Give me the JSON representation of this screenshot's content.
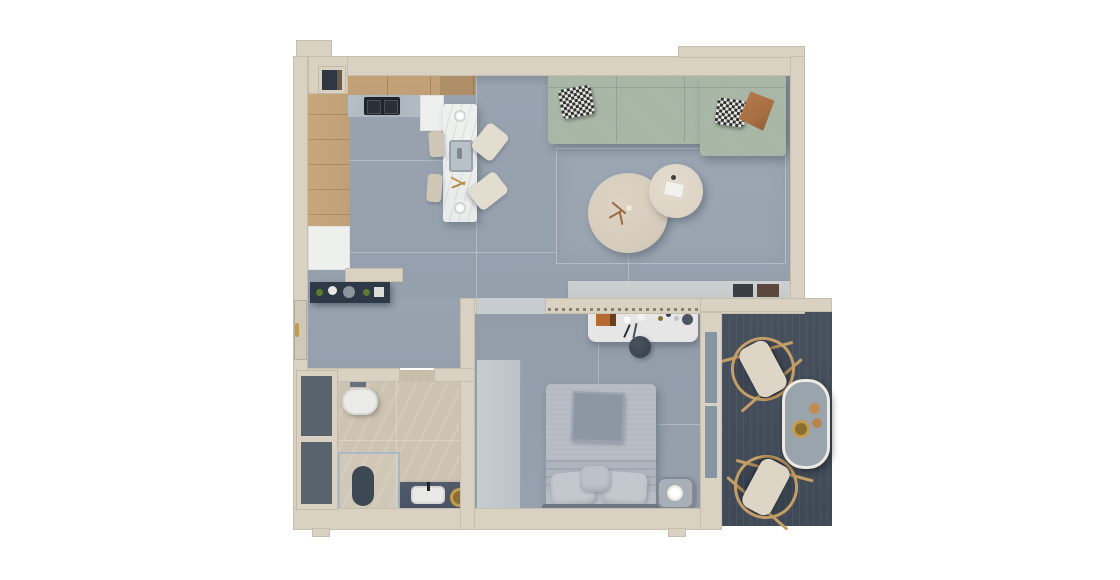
{
  "app": {
    "type": "apartment-floor-plan-3d-top-view",
    "canvas": {
      "width": 1120,
      "height": 580
    },
    "visible_text": []
  },
  "palette": {
    "background": "#ffffff",
    "wall": "#d9d2c3",
    "doorLeaf": "#d0c8b8",
    "floorLiving": "#99a3b0",
    "floorBedroom": "#939daa",
    "floorThreshold": "#c7ccd1",
    "wood": "#c2a077",
    "woodDark": "#a8865e",
    "counterMarble": "#aab3bd",
    "cooktop": "#20242a",
    "cabinetWhite": "#eef0ee",
    "islandMarble": "#e9ebea",
    "chairCream": "#e3ddd0",
    "chairBeige": "#cfc6b6",
    "sofa": "#a7b5a5",
    "pillowCheckDark": "#2e3133",
    "pillowCheckLight": "#e7e4de",
    "pillowRust": "#a76f42",
    "coffeeTableLarge": "#d5cbbb",
    "coffeeTableSmall": "#dcd3c5",
    "tvConsole": "#c6c9c9",
    "artDark": "#3a3e44",
    "artBrown": "#5c473c",
    "sideboardNavy": "#2d3947",
    "plantGreen": "#5d7a2e",
    "gold": "#c59b4e",
    "bathTile": "#cdc3b2",
    "toiletWhite": "#ebebe9",
    "showerTray": "#3e4854",
    "vanityDark": "#4a5363",
    "sinkWhite": "#e9e9e7",
    "shaftDark": "#59636e",
    "wardrobe": "#c5ccd2",
    "deskWhite": "#e5e6e5",
    "accentOrange": "#b46a30",
    "stoolDark": "#3a434e",
    "bedDuvet": "#b5bbc3",
    "bedFold": "#8d97a4",
    "bedSheet": "#aeb5bf",
    "bedPillow": "#c3c8cf",
    "headboard": "#6e7784",
    "nightstand": "#a9afb8",
    "deck": "#47515d",
    "chairWood": "#c49e66",
    "chairCushion": "#ddd6c7",
    "balconyTable": "#9aa4ad",
    "balconyTableRim": "#eceae2",
    "glass": "#8695a2"
  },
  "rooms": [
    {
      "id": "kitchen",
      "furniture": [
        "wood-floor-strip",
        "upper-cabinet-row",
        "cooktop",
        "counter",
        "white-cabinets",
        "marble-island-with-sink",
        "pendant-lights",
        "bar-chairs"
      ]
    },
    {
      "id": "living-room",
      "furniture": [
        "sage-sectional-sofa",
        "checkered-pillows",
        "rust-pillow",
        "round-coffee-table-large",
        "round-coffee-table-small",
        "rug",
        "tv-console-with-decor"
      ]
    },
    {
      "id": "hallway",
      "furniture": [
        "navy-sideboard-with-plants",
        "entry-door-with-gold-handle"
      ]
    },
    {
      "id": "bathroom",
      "furniture": [
        "wall-hung-toilet",
        "walk-in-shower-with-glass",
        "dark-vanity-with-sink",
        "gold-round-mirror",
        "towel-bar",
        "service-shaft-window"
      ]
    },
    {
      "id": "bedroom",
      "furniture": [
        "double-bed-gray-bedding",
        "nightstand-with-lamp",
        "vanity-desk-with-accessories",
        "stool",
        "wardrobe",
        "curtain-track"
      ]
    },
    {
      "id": "balcony",
      "furniture": [
        "dark-wood-deck",
        "two-wicker-lounge-chairs",
        "oval-side-table-with-bowls",
        "sliding-glass-door"
      ]
    }
  ]
}
